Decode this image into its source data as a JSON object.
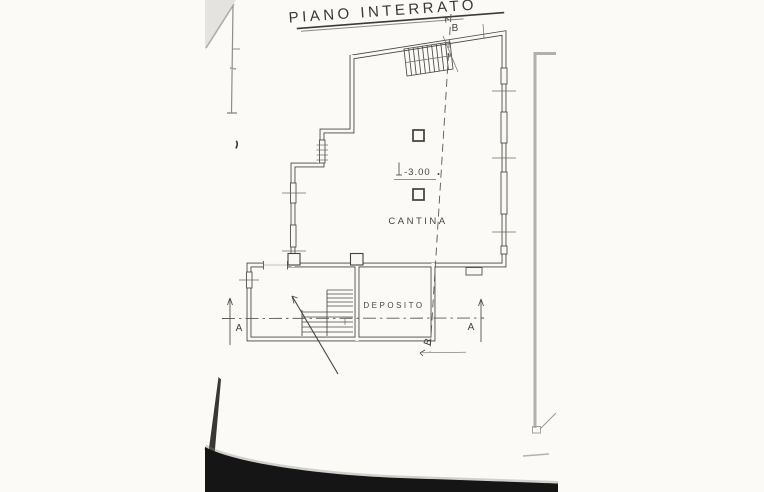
{
  "title": {
    "text": "PIANO INTERRATO"
  },
  "rooms": [
    {
      "label": "CANTINA"
    },
    {
      "label": "DEPOSITO"
    }
  ],
  "annotations": {
    "level_mark": "-3.00",
    "section_a_left": "A",
    "section_a_right": "A",
    "section_b_top": "B",
    "section_b_bottom": "B"
  },
  "colors": {
    "ink": "#45433e",
    "paper": "#f9f8f5",
    "artifact_grey": "#b3b1ad",
    "scan_shadow": "#151515"
  }
}
